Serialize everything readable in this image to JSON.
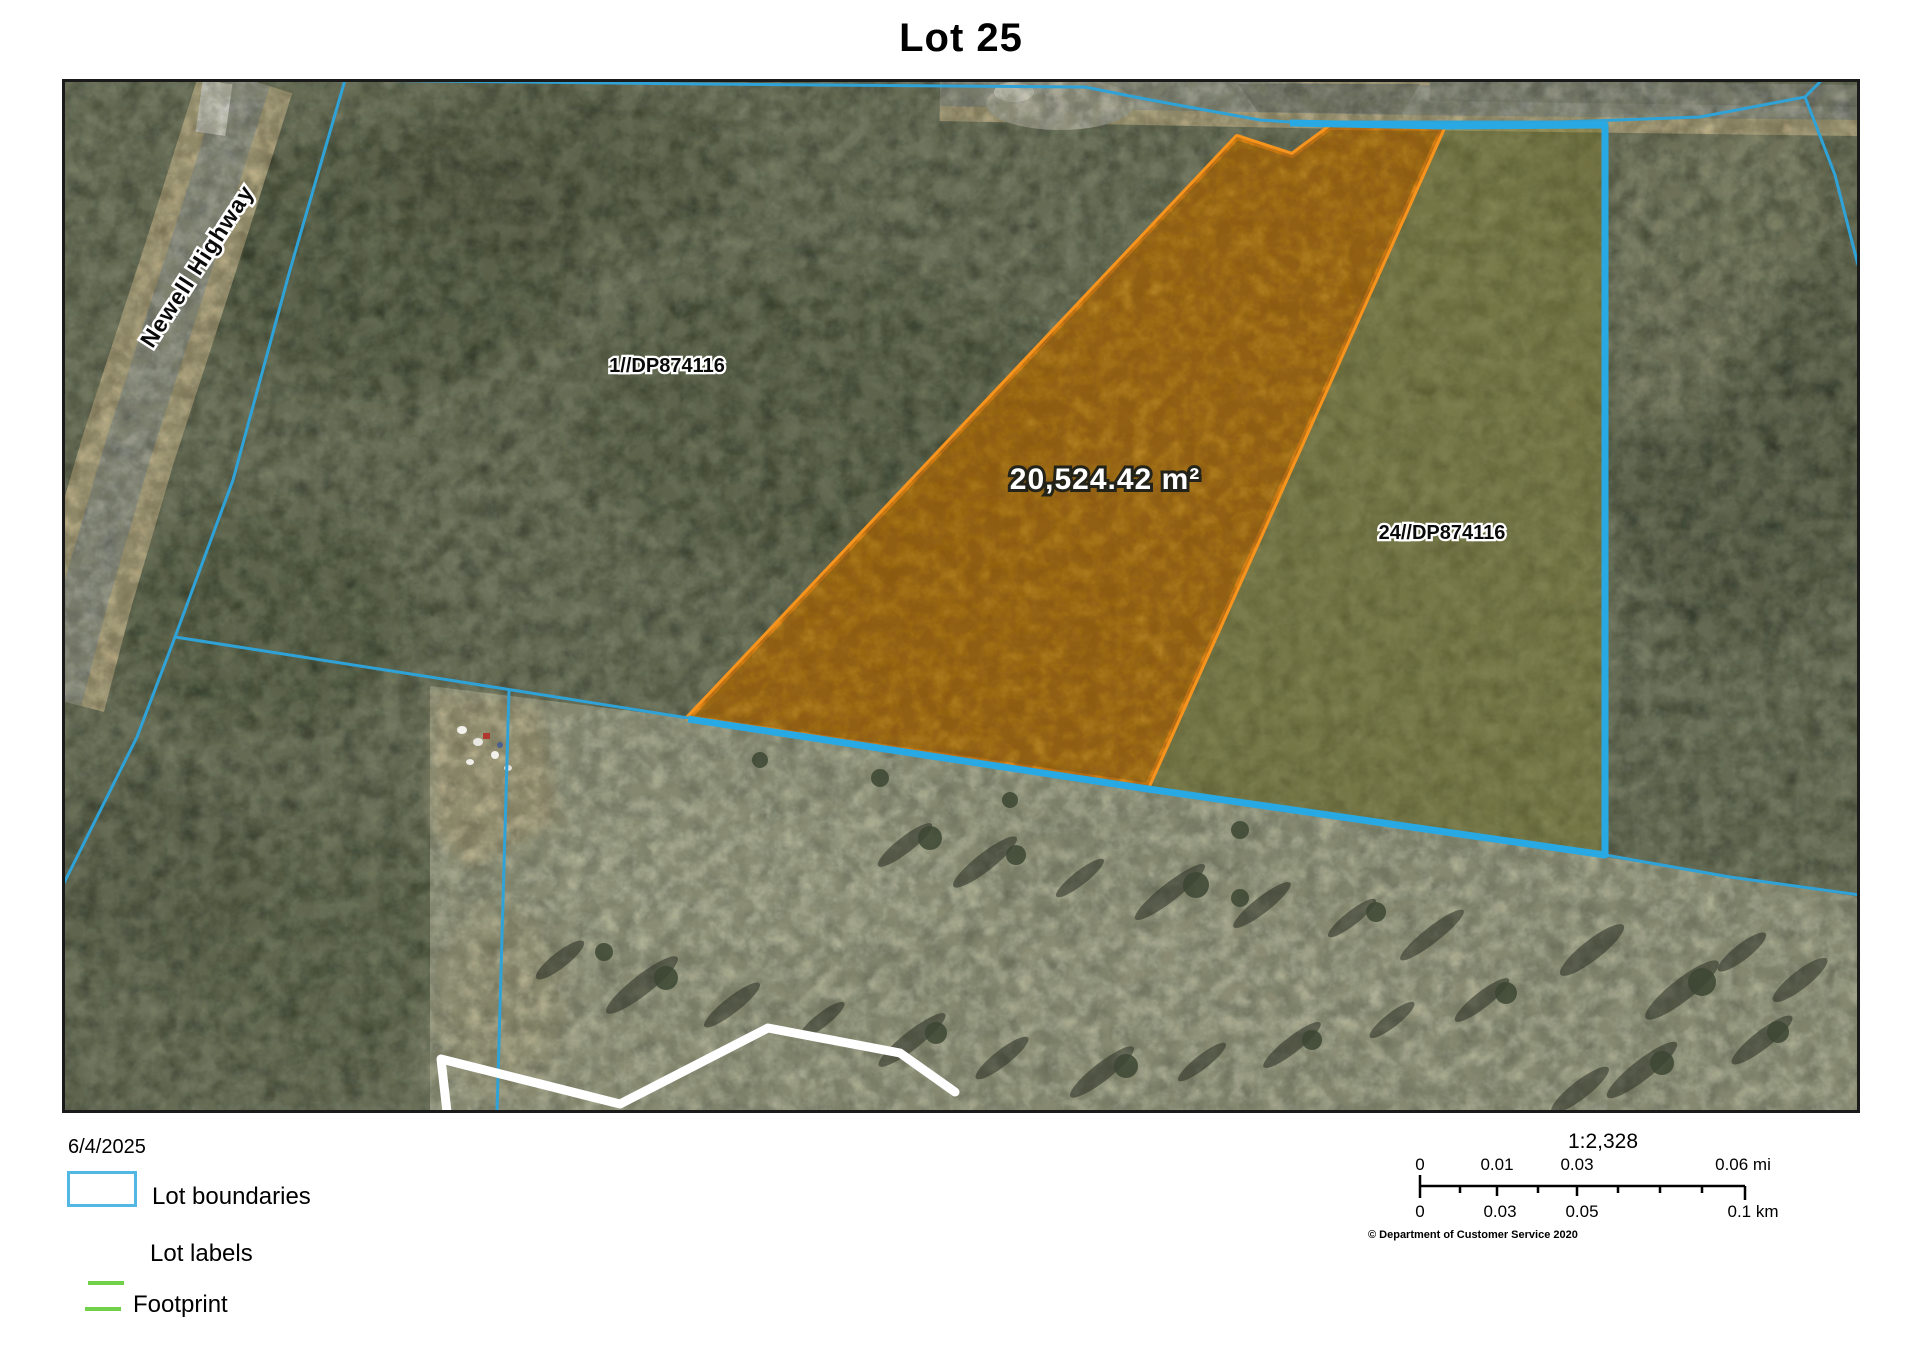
{
  "title": "Lot 25",
  "map": {
    "road_label": "Newell Highway",
    "lot1_label": "1//DP874116",
    "lot24_label": "24//DP874116",
    "area_label": "20,524.42 m²"
  },
  "legend": {
    "date": "6/4/2025",
    "items": [
      {
        "label": "Lot boundaries"
      },
      {
        "label": "Lot labels"
      },
      {
        "label": "Footprint"
      }
    ]
  },
  "scalebar": {
    "ratio": "1:2,328",
    "mi_labels": [
      "0",
      "0.01",
      "0.03",
      "0.06 mi"
    ],
    "km_labels": [
      "0",
      "0.03",
      "0.05",
      "0.1 km"
    ],
    "copyright": "© Department of Customer Service 2020"
  },
  "colors": {
    "lot_boundary": "#2FA3D8",
    "selection_blue": "#29A9E3",
    "highlight_orange": "#F7941D",
    "footprint_green": "#72D14B",
    "legend_swatch": "#52B7E3"
  }
}
